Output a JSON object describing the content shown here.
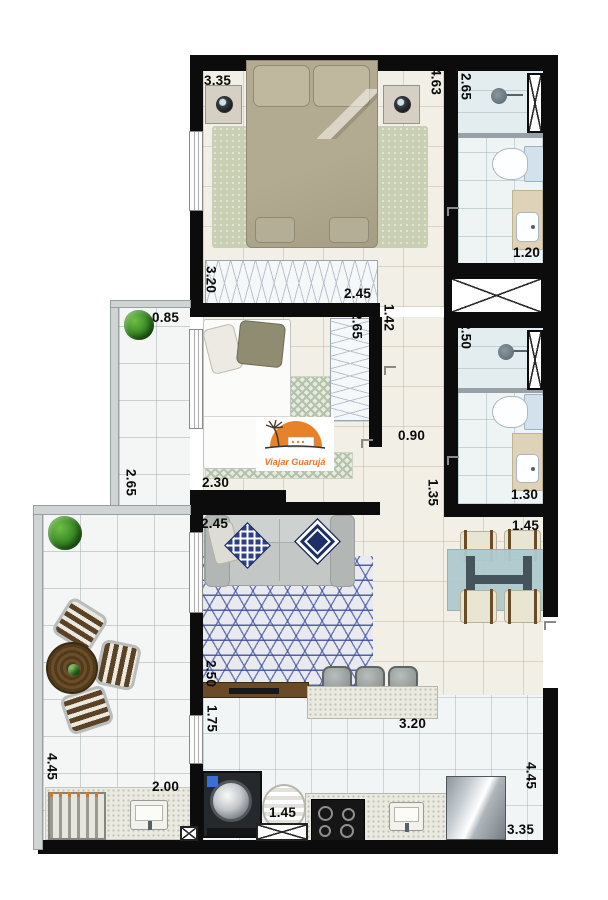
{
  "watermark": {
    "text": "Viajar Guarujá"
  },
  "colors": {
    "wall": "#0c0c0c",
    "label_text": "#0a0a0a",
    "brand_orange": "#e8732a",
    "rug_blue": "#3a4a9a",
    "wood_brown": "#6b4a28",
    "floor_beige": "#f2efe6",
    "floor_tile": "#f2f5f5"
  },
  "floor_plan": {
    "type": "apartment-floor-plan",
    "dimensions": [
      {
        "text": "3.35",
        "x": 204,
        "y": 74,
        "v": false
      },
      {
        "text": "4.63",
        "x": 429,
        "y": 68,
        "v": true
      },
      {
        "text": "2.65",
        "x": 459,
        "y": 73,
        "v": true
      },
      {
        "text": "1.20",
        "x": 513,
        "y": 246,
        "v": false
      },
      {
        "text": "3.20",
        "x": 204,
        "y": 266,
        "v": true
      },
      {
        "text": "2.45",
        "x": 344,
        "y": 287,
        "v": false
      },
      {
        "text": "0.85",
        "x": 152,
        "y": 311,
        "v": false
      },
      {
        "text": "2.65",
        "x": 350,
        "y": 312,
        "v": true
      },
      {
        "text": "1.42",
        "x": 382,
        "y": 304,
        "v": true
      },
      {
        "text": "2.50",
        "x": 459,
        "y": 322,
        "v": true
      },
      {
        "text": "0.90",
        "x": 398,
        "y": 429,
        "v": false
      },
      {
        "text": "2.65",
        "x": 124,
        "y": 469,
        "v": true
      },
      {
        "text": "2.30",
        "x": 202,
        "y": 476,
        "v": false
      },
      {
        "text": "1.35",
        "x": 426,
        "y": 479,
        "v": true
      },
      {
        "text": "1.30",
        "x": 511,
        "y": 488,
        "v": false
      },
      {
        "text": "1.45",
        "x": 512,
        "y": 519,
        "v": false
      },
      {
        "text": "2.45",
        "x": 201,
        "y": 517,
        "v": false
      },
      {
        "text": "2.50",
        "x": 204,
        "y": 660,
        "v": true
      },
      {
        "text": "1.75",
        "x": 205,
        "y": 705,
        "v": true
      },
      {
        "text": "3.20",
        "x": 399,
        "y": 717,
        "v": false
      },
      {
        "text": "2.00",
        "x": 152,
        "y": 780,
        "v": false
      },
      {
        "text": "4.45",
        "x": 45,
        "y": 753,
        "v": true
      },
      {
        "text": "1.45",
        "x": 269,
        "y": 806,
        "v": false
      },
      {
        "text": "4.45",
        "x": 524,
        "y": 762,
        "v": true
      },
      {
        "text": "3.35",
        "x": 507,
        "y": 823,
        "v": false
      }
    ]
  }
}
